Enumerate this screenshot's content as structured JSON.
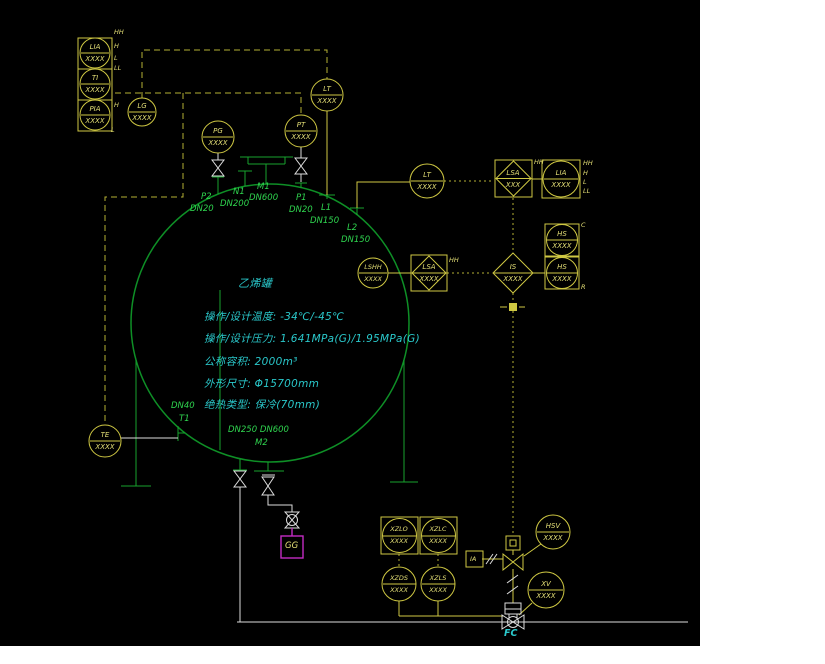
{
  "drawing": {
    "title": "乙烯罐",
    "specs": {
      "s1": "操作/设计温度: -34℃/-45℃",
      "s2": "操作/设计压力: 1.641MPa(G)/1.95MPa(G)",
      "s3": "公称容积: 2000m³",
      "s4": "外形尺寸: Φ15700mm",
      "s5": "绝热类型: 保冷(70mm)"
    },
    "instruments": {
      "lia1": {
        "tag": "LIA",
        "value": "XXXX",
        "hh": "HH",
        "h": "H",
        "l": "L",
        "ll": "LL"
      },
      "ti": {
        "tag": "TI",
        "value": "XXXX"
      },
      "pia": {
        "tag": "PIA",
        "value": "XXXX",
        "h": "H",
        "l": "L"
      },
      "lg": {
        "tag": "LG",
        "value": "XXXX"
      },
      "pg": {
        "tag": "PG",
        "value": "XXXX"
      },
      "pt": {
        "tag": "PT",
        "value": "XXXX"
      },
      "lt1": {
        "tag": "LT",
        "value": "XXXX"
      },
      "lt2": {
        "tag": "LT",
        "value": "XXXX"
      },
      "lsa1": {
        "tag": "LSA",
        "value": "XXX",
        "alarm": "HH"
      },
      "lia2": {
        "tag": "LIA",
        "value": "XXXX",
        "hh": "HH",
        "h": "H",
        "l": "L",
        "ll": "LL"
      },
      "lshh": {
        "tag": "LSHH",
        "value": "XXXX"
      },
      "lsa2": {
        "tag": "LSA",
        "value": "XXXX",
        "alarm": "HH"
      },
      "is": {
        "tag": "IS",
        "value": "XXXX"
      },
      "hs1": {
        "tag": "HS",
        "value": "XXXX",
        "suffix": "C"
      },
      "hs2": {
        "tag": "HS",
        "value": "XXXX",
        "suffix": "R"
      },
      "te": {
        "tag": "TE",
        "value": "XXXX"
      },
      "hsv": {
        "tag": "HSV",
        "value": "XXXX"
      },
      "xv": {
        "tag": "XV",
        "value": "XXXX"
      },
      "xzlo": {
        "tag": "XZLO",
        "value": "XXXX"
      },
      "xzlc": {
        "tag": "XZLC",
        "value": "XXXX"
      },
      "xzds": {
        "tag": "XZDS",
        "value": "XXXX"
      },
      "xzls": {
        "tag": "XZLS",
        "value": "XXXX"
      },
      "ia": {
        "tag": "IA"
      }
    },
    "nozzles": {
      "p2": {
        "tag": "P2",
        "dn": "DN20"
      },
      "n1": {
        "tag": "N1",
        "dn": "DN200"
      },
      "m1": {
        "tag": "M1",
        "dn": "DN600"
      },
      "p1": {
        "tag": "P1",
        "dn": "DN20"
      },
      "l1": {
        "tag": "L1",
        "dn": "DN150"
      },
      "l2": {
        "tag": "L2",
        "dn": "DN150"
      },
      "t1": {
        "tag": "T1",
        "dn": "DN40"
      },
      "m2": {
        "tag": "M2",
        "dn": "DN250 DN600"
      }
    },
    "labels": {
      "gg": "GG",
      "fc": "FC"
    },
    "colors": {
      "background": "#000000",
      "instrument_yellow": "#cfc843",
      "tank_green": "#0e8f26",
      "label_green": "#2fd54f",
      "spec_cyan": "#2ac8cb",
      "pipe_white": "#dcdcdc",
      "vent_magenta": "#c32cc3"
    }
  }
}
